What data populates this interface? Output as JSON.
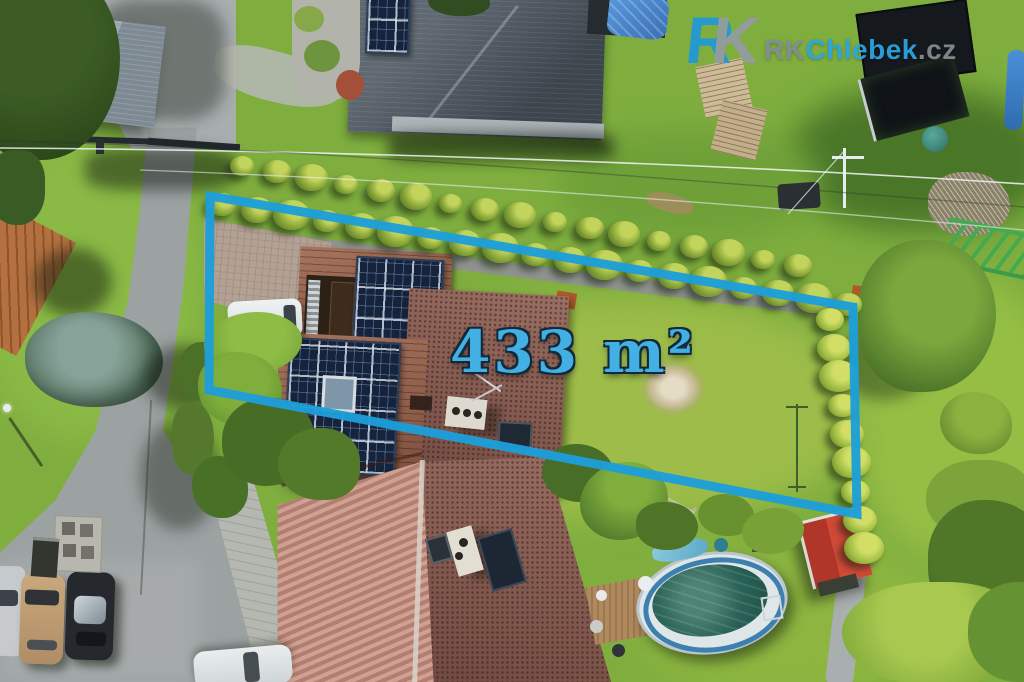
{
  "meta": {
    "type": "aerial-property-photo",
    "width": 1024,
    "height": 682
  },
  "overlay": {
    "area_label": "433 m²",
    "outline_color": "#1d9ed9",
    "area_label_color": "#42b0e2"
  },
  "watermark": {
    "logo_r": "R",
    "logo_k": "K",
    "text_prefix": "RK",
    "text_brand": "Chlebek",
    "text_suffix": ".cz",
    "brand_color": "#2aa6e2",
    "gray_color": "#848d94"
  },
  "scene": {
    "hedge_upper": {
      "x1": 242,
      "y1": 168,
      "x2": 798,
      "y2": 268,
      "count": 17,
      "r": 14,
      "style": "cone"
    },
    "hedge_lower": {
      "x1": 222,
      "y1": 207,
      "x2": 848,
      "y2": 307,
      "count": 19,
      "r": 16,
      "style": "cone"
    },
    "cone_row_right": {
      "x1": 830,
      "y1": 322,
      "x2": 864,
      "y2": 552,
      "count": 9,
      "r": 17,
      "style": "cone bright"
    },
    "palette": {
      "lawn": "#7fae3f",
      "road": "#9ca1a2",
      "roof_dark_house": "#4a545e",
      "roof_property": "#95604a",
      "roof_bottom_left": "#c39084",
      "roof_bottom_right": "#8f5e52",
      "solar_panel": "#16233d",
      "pool_water": "#1d4f46",
      "shed_red": "#c23b2e"
    }
  }
}
